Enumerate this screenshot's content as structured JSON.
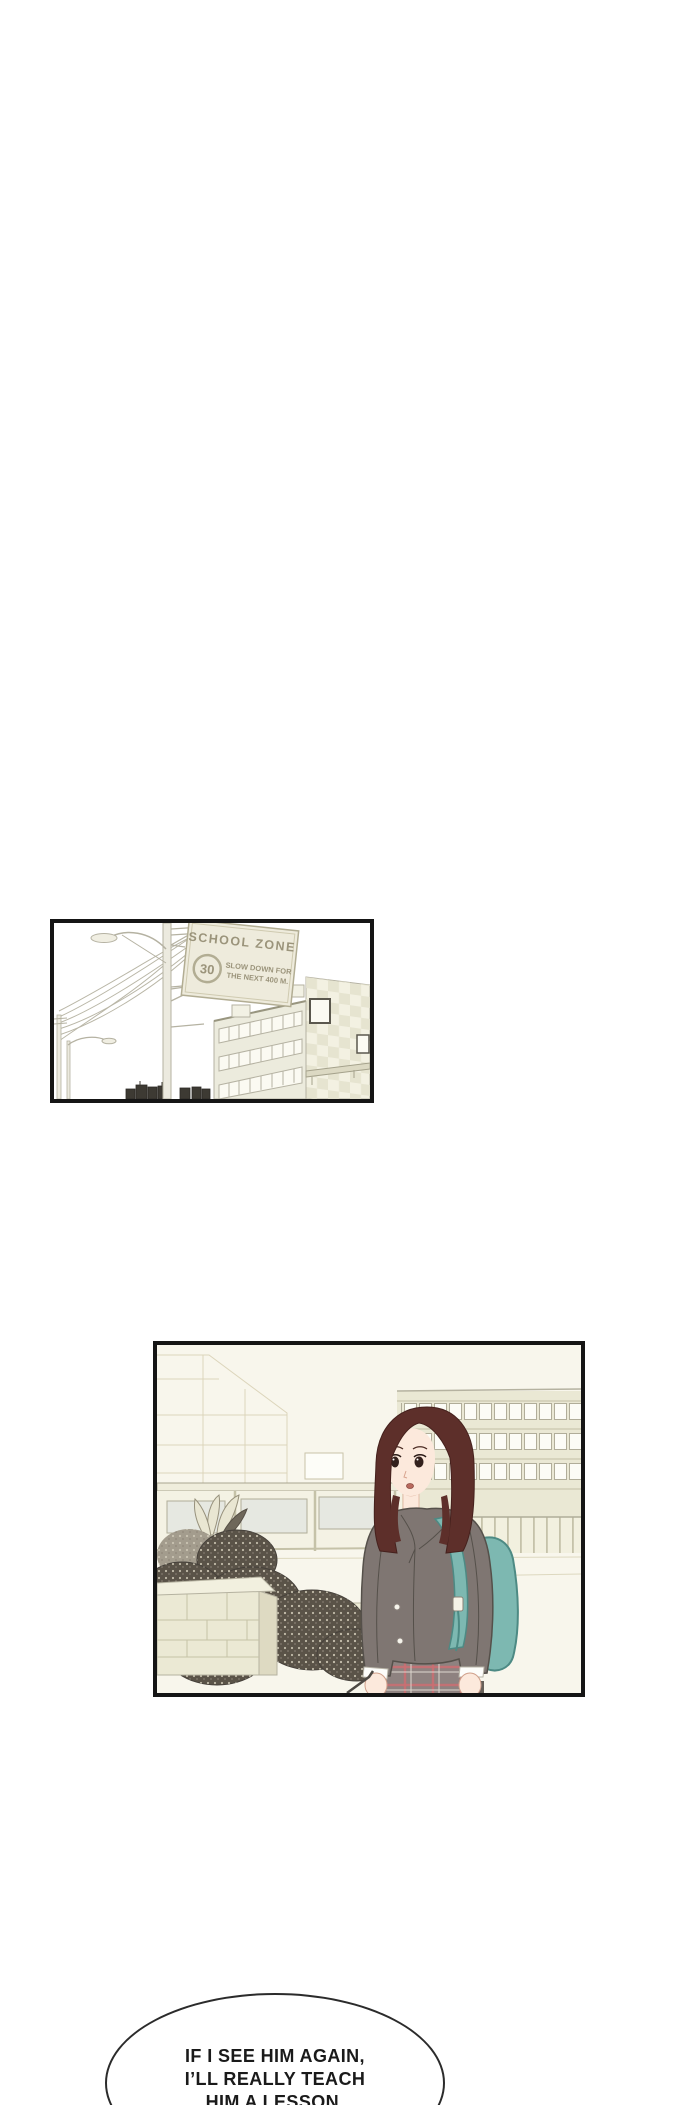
{
  "sign": {
    "title": "SCHOOL ZONE",
    "speed_limit": "30",
    "warning_line1": "SLOW DOWN FOR",
    "warning_line2": "THE NEXT 400 M."
  },
  "speech_bubble": {
    "line1": "IF I SEE HIM AGAIN,",
    "line2": "I’LL REALLY TEACH",
    "line3": "HIM A LESSON."
  },
  "colors": {
    "panel_border": "#151515",
    "line_art": "#b5b2a2",
    "sign_bg": "#eeebdc",
    "sign_text": "#9b947b",
    "panel2_bg": "#f8f6ec",
    "faint_line": "#dcd5bb",
    "building_band": "#eae8d4",
    "window_frame": "#b0ad99",
    "stone": "#ebe9d4",
    "bush_dark": "#5a5348",
    "bush_speckle": "#d3cdba",
    "hair": "#5d2f2a",
    "skin": "#fce9dc",
    "blazer": "#7f7672",
    "blazer_line": "#55504a",
    "sweater": "#514b45",
    "tie": "#6f3230",
    "shirt": "#fdfdfa",
    "backpack": "#7db8b1",
    "backpack_dark": "#4d8a84",
    "skirt": "#8e8280",
    "skirt_plaid": "#cc6f72",
    "legs": "#676059",
    "bubble_border": "#2b2b2b",
    "bubble_text": "#1a1a1a"
  }
}
